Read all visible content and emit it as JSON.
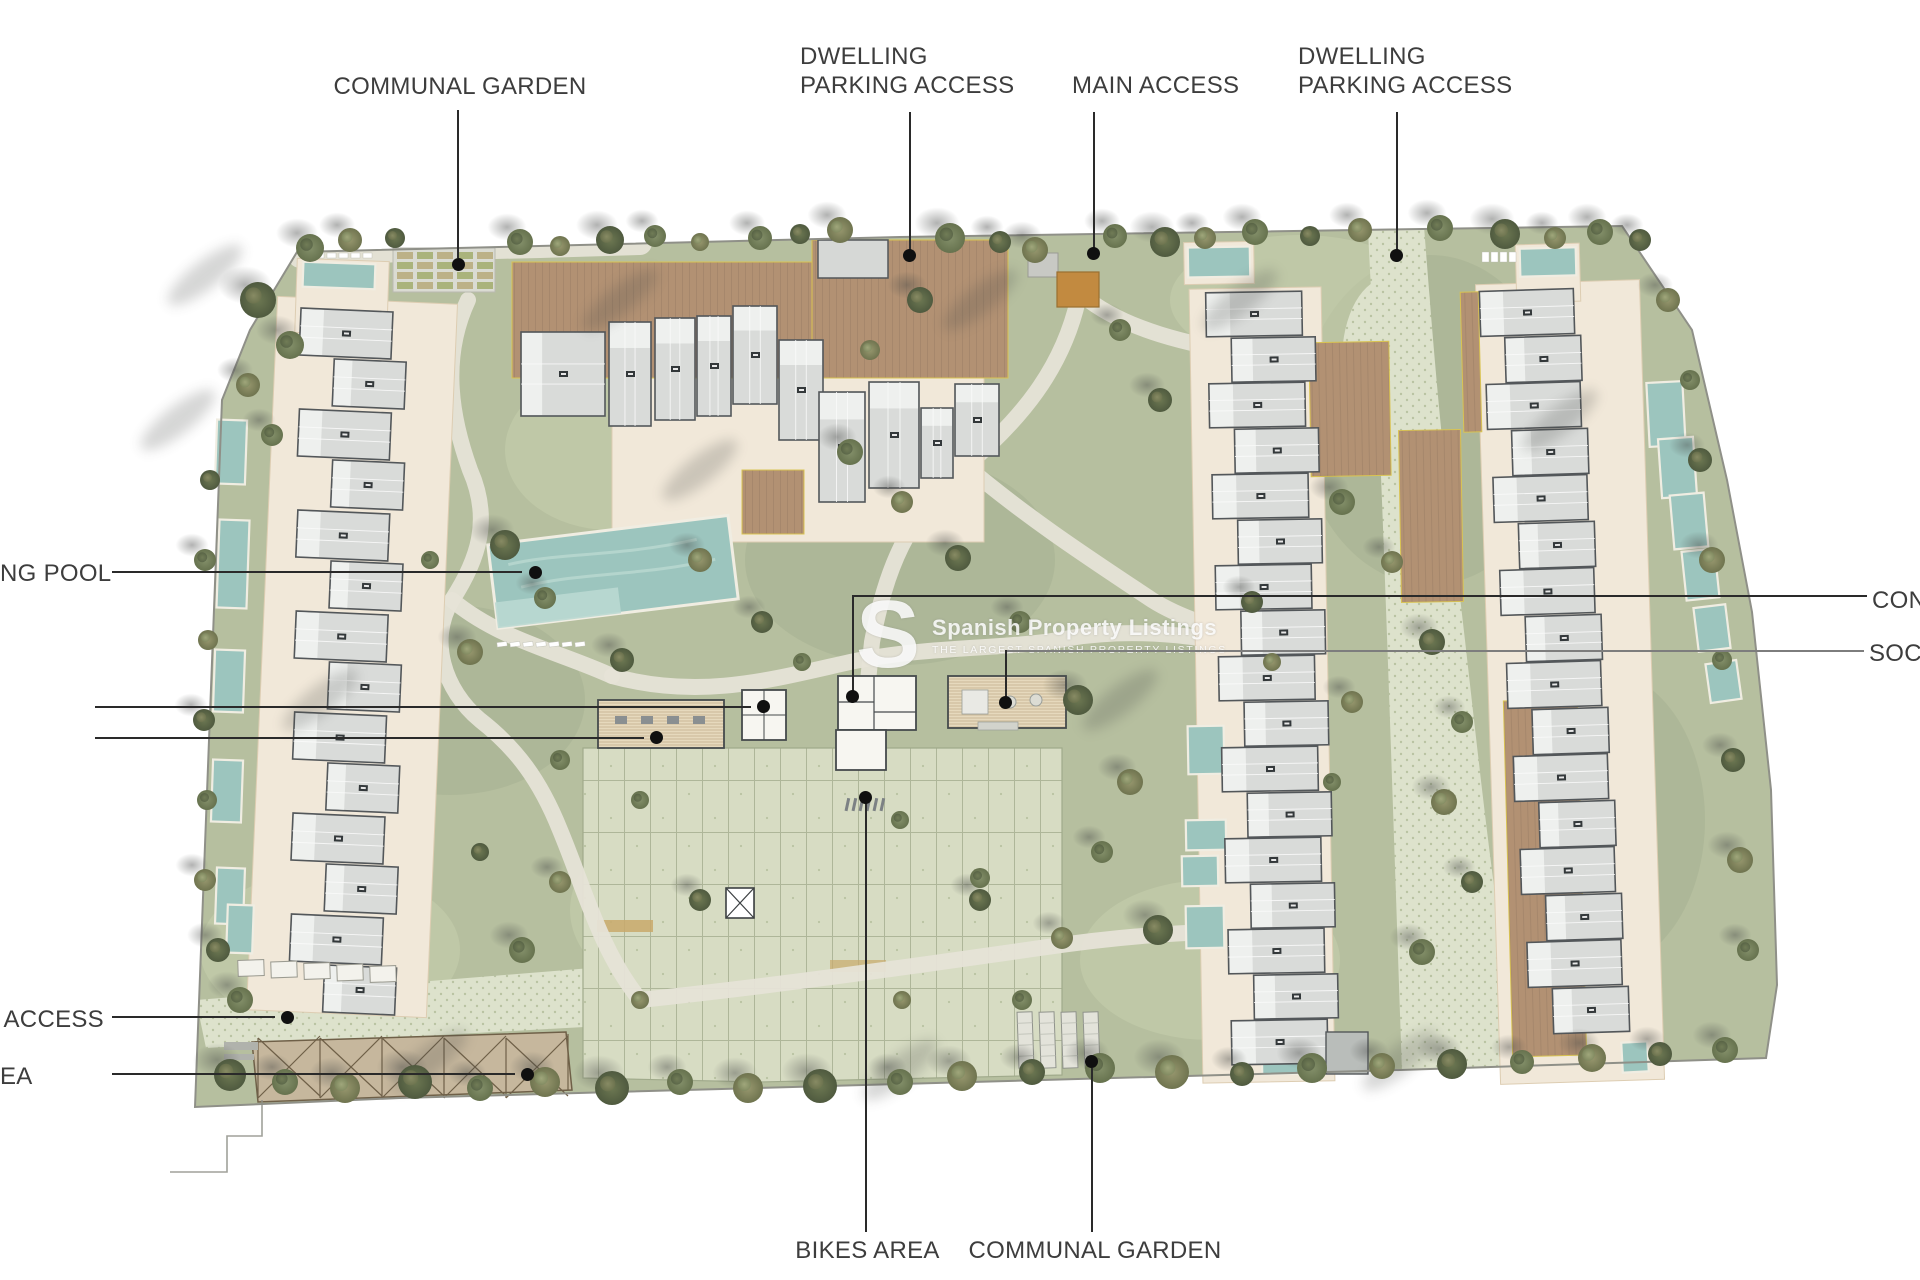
{
  "watermark": {
    "logo_letter": "S",
    "title": "Spanish Property Listings",
    "tagline": "THE LARGEST SPANISH PROPERTY LISTINGS"
  },
  "annotations": {
    "communal_garden_top": "COMMUNAL GARDEN",
    "dwelling_parking_left": "DWELLING PARKING ACCESS",
    "main_access": "MAIN ACCESS",
    "dwelling_parking_right": "DWELLING PARKING ACCESS",
    "swimming_pool_partial": "NG POOL",
    "access_partial": "ACCESS",
    "area_partial": "EA",
    "concierge_partial": "CON",
    "social_partial": "SOCIA",
    "bikes_area": "BIKES AREA",
    "communal_garden_bottom": "COMMUNAL GARDEN"
  },
  "colors": {
    "label_color": "#3d3d3d",
    "leader_color": "#2a2a2a",
    "dot_color": "#101010",
    "lawn_base": "#b6bf9f",
    "lawn_light": "#c6cfad",
    "lawn_dark": "#a6b192",
    "speckle_bg": "#dde2cc",
    "speckle_dot": "#b9c3a2",
    "grid_bg": "#d7dcc3",
    "grid_line": "#a0aa8b",
    "path": "#e6e3d7",
    "apron": "#f1e8d9",
    "apron_edge": "#ddcdb2",
    "deck_brown": "#b29173",
    "mulch": "#a3846a",
    "pergola": "#c6b79d",
    "pergola_line": "#6f6048",
    "roof": "#d9dbd9",
    "roof_light": "#eef0ee",
    "roof_outline": "#53575a",
    "white_bldg": "#f7f6f1",
    "slat_bg": "#e6d9bd",
    "slat_line": "#c9b896",
    "pool_water": "#9cc5be",
    "pool_light": "#bad8d1",
    "pool_deck": "#f0ede2",
    "gate_orange": "#c28a40",
    "yellow_trim": "#d9c352",
    "boundary": "#8f9088",
    "tree_green": "#84906a",
    "tree_dark": "#6d7852",
    "tree_olive": "#97976e",
    "tree_pale": "#a9b285",
    "shadow": "#464846"
  }
}
